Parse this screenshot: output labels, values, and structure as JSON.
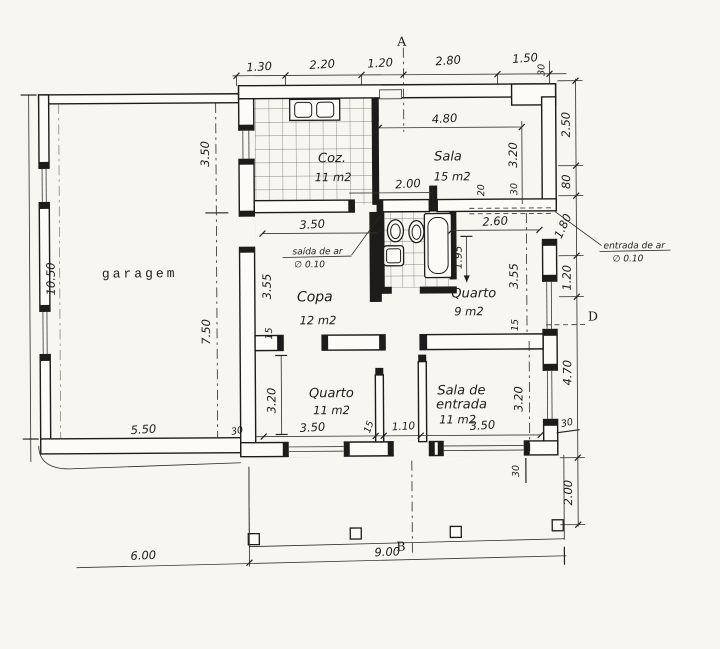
{
  "colors": {
    "paper": "#f7f6f1",
    "ink": "#1d1c1a"
  },
  "markers": {
    "a": "A",
    "b": "B",
    "d": "D"
  },
  "rooms": {
    "garage": {
      "label": "garagem"
    },
    "kitchen": {
      "label": "Coz.",
      "area": "11 m2"
    },
    "sala": {
      "label": "Sala",
      "area": "15 m2"
    },
    "copa": {
      "label": "Copa",
      "area": "12 m2"
    },
    "quarto9": {
      "label": "Quarto",
      "area": "9 m2"
    },
    "quarto11": {
      "label": "Quarto",
      "area": "11 m2"
    },
    "entrada": {
      "line1": "Sala de",
      "line2": "entrada",
      "area": "11 m2"
    }
  },
  "annotations": {
    "air_outlet_label": "saída de ar",
    "air_outlet_dia": "∅ 0.10",
    "air_inlet_label": "entrada de ar",
    "air_inlet_dia": "∅ 0.10"
  },
  "dims": {
    "top": {
      "d1": "1.30",
      "d2": "2.20",
      "d3": "1.20",
      "d4": "2.80",
      "d5": "1.50",
      "wall": "30"
    },
    "right": {
      "d1": "2.50",
      "d2": "80",
      "d3": "1.80",
      "d4": "1.20",
      "d5": "4.70",
      "d6": "2.00",
      "wall": "30"
    },
    "left": {
      "d1": "10.50"
    },
    "bottom": {
      "d1": "6.00",
      "d2": "9.00",
      "wall": "30"
    },
    "garage": {
      "v1": "3.50",
      "v2": "7.50",
      "w": "5.50",
      "wall": "30"
    },
    "sala": {
      "w": "4.80",
      "h": "3.20",
      "wall": "30",
      "ledge": "20",
      "hall": "2.00"
    },
    "copa": {
      "w": "3.50",
      "h": "3.55",
      "wall": "15"
    },
    "quarto9": {
      "w": "2.60",
      "closet": "1.95",
      "h": "3.55",
      "wall": "15"
    },
    "quarto11": {
      "h": "3.20",
      "w": "3.50",
      "wall": "15",
      "door": "1.10"
    },
    "entrada": {
      "h": "3.20",
      "w": "3.50"
    }
  }
}
